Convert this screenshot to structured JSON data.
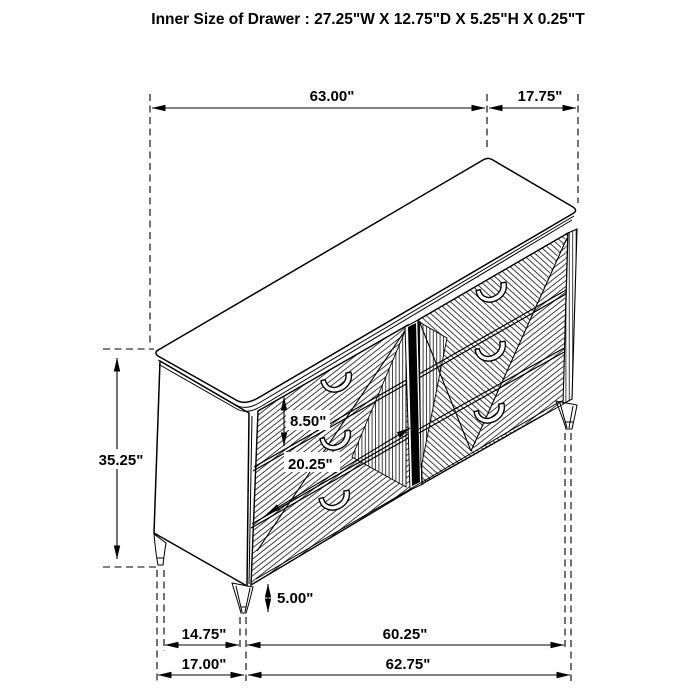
{
  "page": {
    "title": "Inner Size of Drawer : 27.25\"W X 12.75\"D X 5.25\"H X 0.25\"T",
    "background": "#ffffff",
    "line_color": "#000000"
  },
  "dims": {
    "overall_width": "63.00\"",
    "top_depth": "17.75\"",
    "overall_height": "35.25\"",
    "drawer_front_height": "8.50\"",
    "drawer_front_width": "20.25\"",
    "leg_height": "5.00\"",
    "foot_depth_inner": "14.75\"",
    "foot_width_inner": "60.25\"",
    "foot_depth_outer": "17.00\"",
    "foot_width_outer": "62.75\""
  }
}
